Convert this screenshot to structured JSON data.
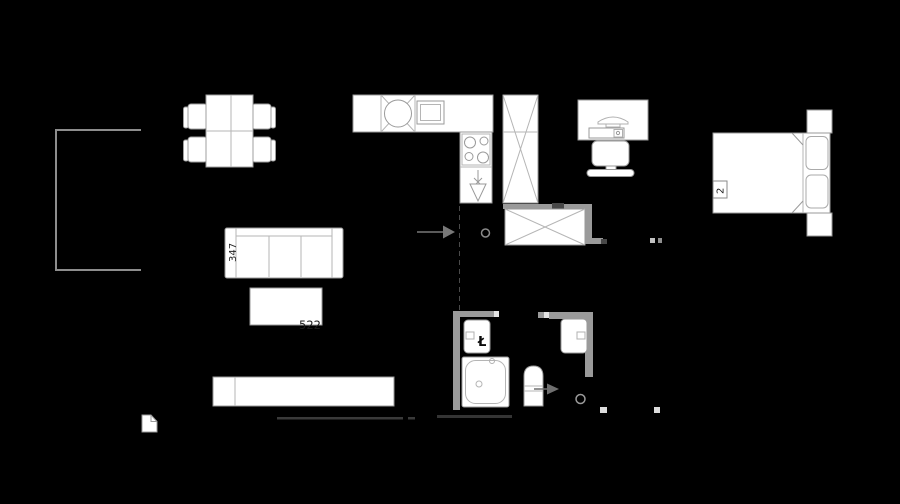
{
  "canvas": {
    "width": 900,
    "height": 504,
    "background": "#000000"
  },
  "colors": {
    "furniture_fill": "#ffffff",
    "furniture_stroke": "#9a9a9a",
    "inner_line": "#b5b5b5",
    "wall_gray": "#9a9a9a",
    "wall_dark": "#484848",
    "wall_cap": "#e3e3e3",
    "floor_line": "#3a3a3a",
    "railing": "#8d8d8d",
    "arrow": "#787878",
    "label_dark": "#1c1c1c",
    "label_black": "#0a0a0a",
    "label_faint": "#8f8f8f"
  },
  "labels": {
    "sofa_width": "347",
    "coffee_table_width": "522",
    "bathroom_symbol": "Ł",
    "shower_size": "90x90",
    "bed_number": "2"
  },
  "elements": [
    "balcony-railing",
    "dining-table",
    "dining-chair",
    "kitchen-counter",
    "kitchen-sink",
    "oven",
    "cooktop",
    "dishwasher-symbol",
    "tall-cabinet",
    "hallway-wardrobe",
    "entrance-arrow",
    "door-axis-circle",
    "door-swing-dashed-line",
    "sofa",
    "coffee-table",
    "tv-bench",
    "threshold-icon",
    "desk",
    "monitor",
    "keyboard",
    "desk-chair",
    "bed",
    "pillow",
    "nightstand",
    "washbasin",
    "shower",
    "toilet",
    "toilet-arrow",
    "door-frame-mark"
  ]
}
